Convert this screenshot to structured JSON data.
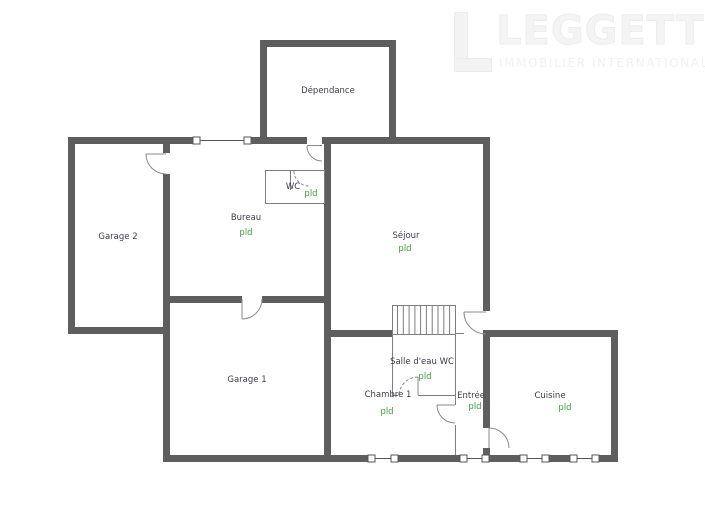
{
  "logo": {
    "brand": "LEGGETT",
    "tagline": "IMMOBILIER INTERNATIONAL",
    "color": "#f2f2f2"
  },
  "plan": {
    "wall_color": "#5e5e5e",
    "thin_line_color": "#7d7d7d",
    "label_color": "#3c3c4e",
    "tag_color": "#3f9e3f",
    "rooms": [
      {
        "name": "dependance",
        "label": "Dépendance"
      },
      {
        "name": "garage-2",
        "label": "Garage 2"
      },
      {
        "name": "bureau",
        "label": "Bureau",
        "tag": "pld"
      },
      {
        "name": "wc",
        "label": "WC",
        "tag": "pld"
      },
      {
        "name": "sejour",
        "label": "Séjour",
        "tag": "pld"
      },
      {
        "name": "garage-1",
        "label": "Garage 1"
      },
      {
        "name": "salle-deau-wc",
        "label": "Salle d'eau WC",
        "tag": "pld"
      },
      {
        "name": "chambre-1",
        "label": "Chambre 1",
        "tag": "pld"
      },
      {
        "name": "entree",
        "label": "Entrée",
        "tag": "pld"
      },
      {
        "name": "cuisine",
        "label": "Cuisine",
        "tag": "pld"
      }
    ]
  }
}
